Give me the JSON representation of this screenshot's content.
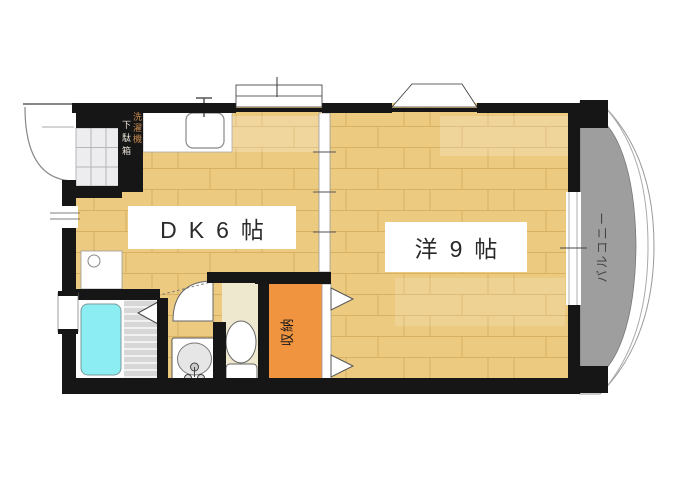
{
  "plan": {
    "rooms": {
      "dining_kitchen": {
        "label": "DK6帖"
      },
      "western_room": {
        "label": "洋9帖"
      },
      "closet": {
        "label": "収納"
      },
      "balcony": {
        "label": "バルコニー"
      }
    },
    "entrance": {
      "washer_label": "洗濯機",
      "shoe_cabinet_label": "下駄箱"
    },
    "colors": {
      "floor": "#eccb81",
      "floor_line": "#d9b162",
      "wall": "#161616",
      "closet_orange": "#f09440",
      "tub_cyan": "#8ceef2",
      "balcony_gray": "#9e9e9e",
      "toilet_floor": "#eee8cf",
      "tile": "#ededef"
    }
  }
}
